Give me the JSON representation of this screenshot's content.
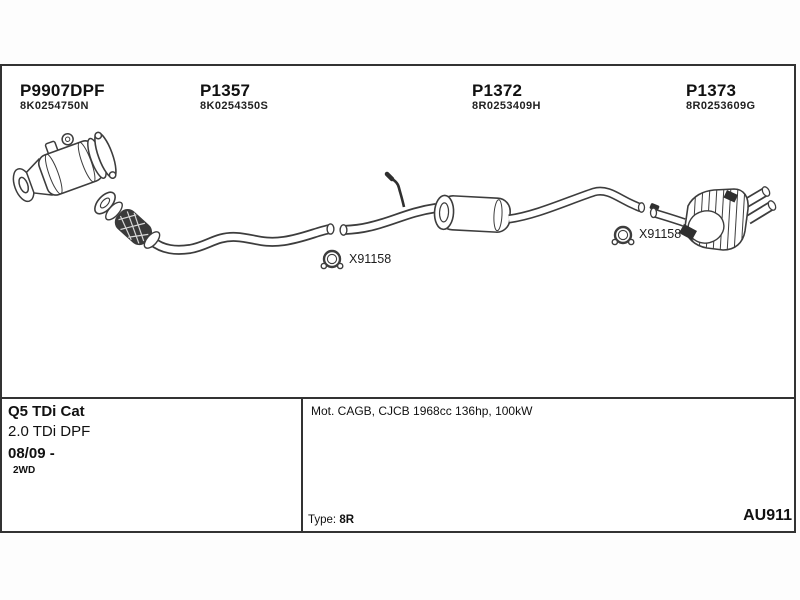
{
  "parts": [
    {
      "code": "P9907DPF",
      "oem": "8K0254750N"
    },
    {
      "code": "P1357",
      "oem": "8K0254350S"
    },
    {
      "code": "P1372",
      "oem": "8R0253409H"
    },
    {
      "code": "P1373",
      "oem": "8R0253609G"
    }
  ],
  "clamp": {
    "label": "X91158"
  },
  "vehicle": {
    "model": "Q5 TDi Cat",
    "engine": "2.0 TDi DPF",
    "period": "08/09 -",
    "drive": "2WD"
  },
  "engine_info": "Mot. CAGB, CJCB 1968cc 136hp, 100kW",
  "type": {
    "label": "Type:",
    "value": "8R"
  },
  "reference": "AU911",
  "colors": {
    "line": "#3d3d3d",
    "dark_fill": "#2f2f2f",
    "border": "#333333",
    "text": "#111111"
  }
}
